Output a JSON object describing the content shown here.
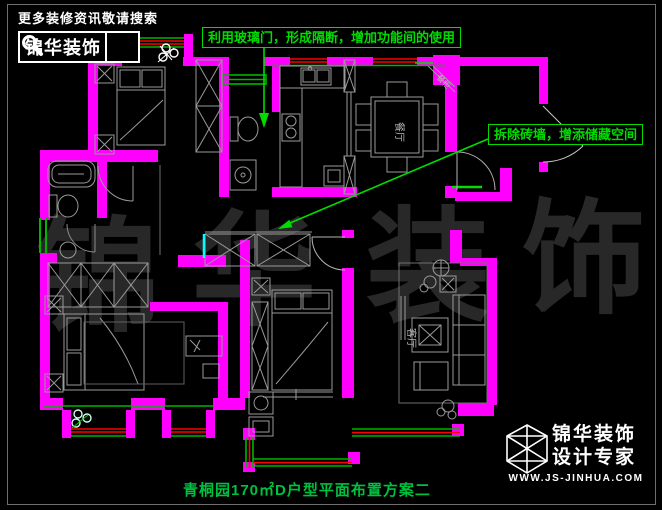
{
  "header": {
    "tagline": "更多装修资讯敬请搜索",
    "brand": "锦华装饰"
  },
  "annotations": {
    "glass_door": "利用玻璃门，形成隔断，增加功能间的使用",
    "remove_wall": "拆除砖墙，增添储藏空间"
  },
  "room_labels": {
    "dining": "餐厅",
    "living": "客厅",
    "cabinet": "餐柜"
  },
  "watermark": {
    "c1": "锦",
    "c2": "华",
    "c3": "装",
    "c4": "饰"
  },
  "caption": "青桐园170㎡D户型平面布置方案二",
  "footer": {
    "brand_line1": "锦华装饰",
    "brand_line2": "设计专家",
    "website": "WWW.JS-JINHUA.COM"
  },
  "colors": {
    "wall": "#FF00FF",
    "annotation_green": "#00DC00",
    "window_red": "#FF0000",
    "glass_cyan": "#00FFFF",
    "caption_green": "#00C040",
    "furniture_gray": "#9A9A9A"
  }
}
